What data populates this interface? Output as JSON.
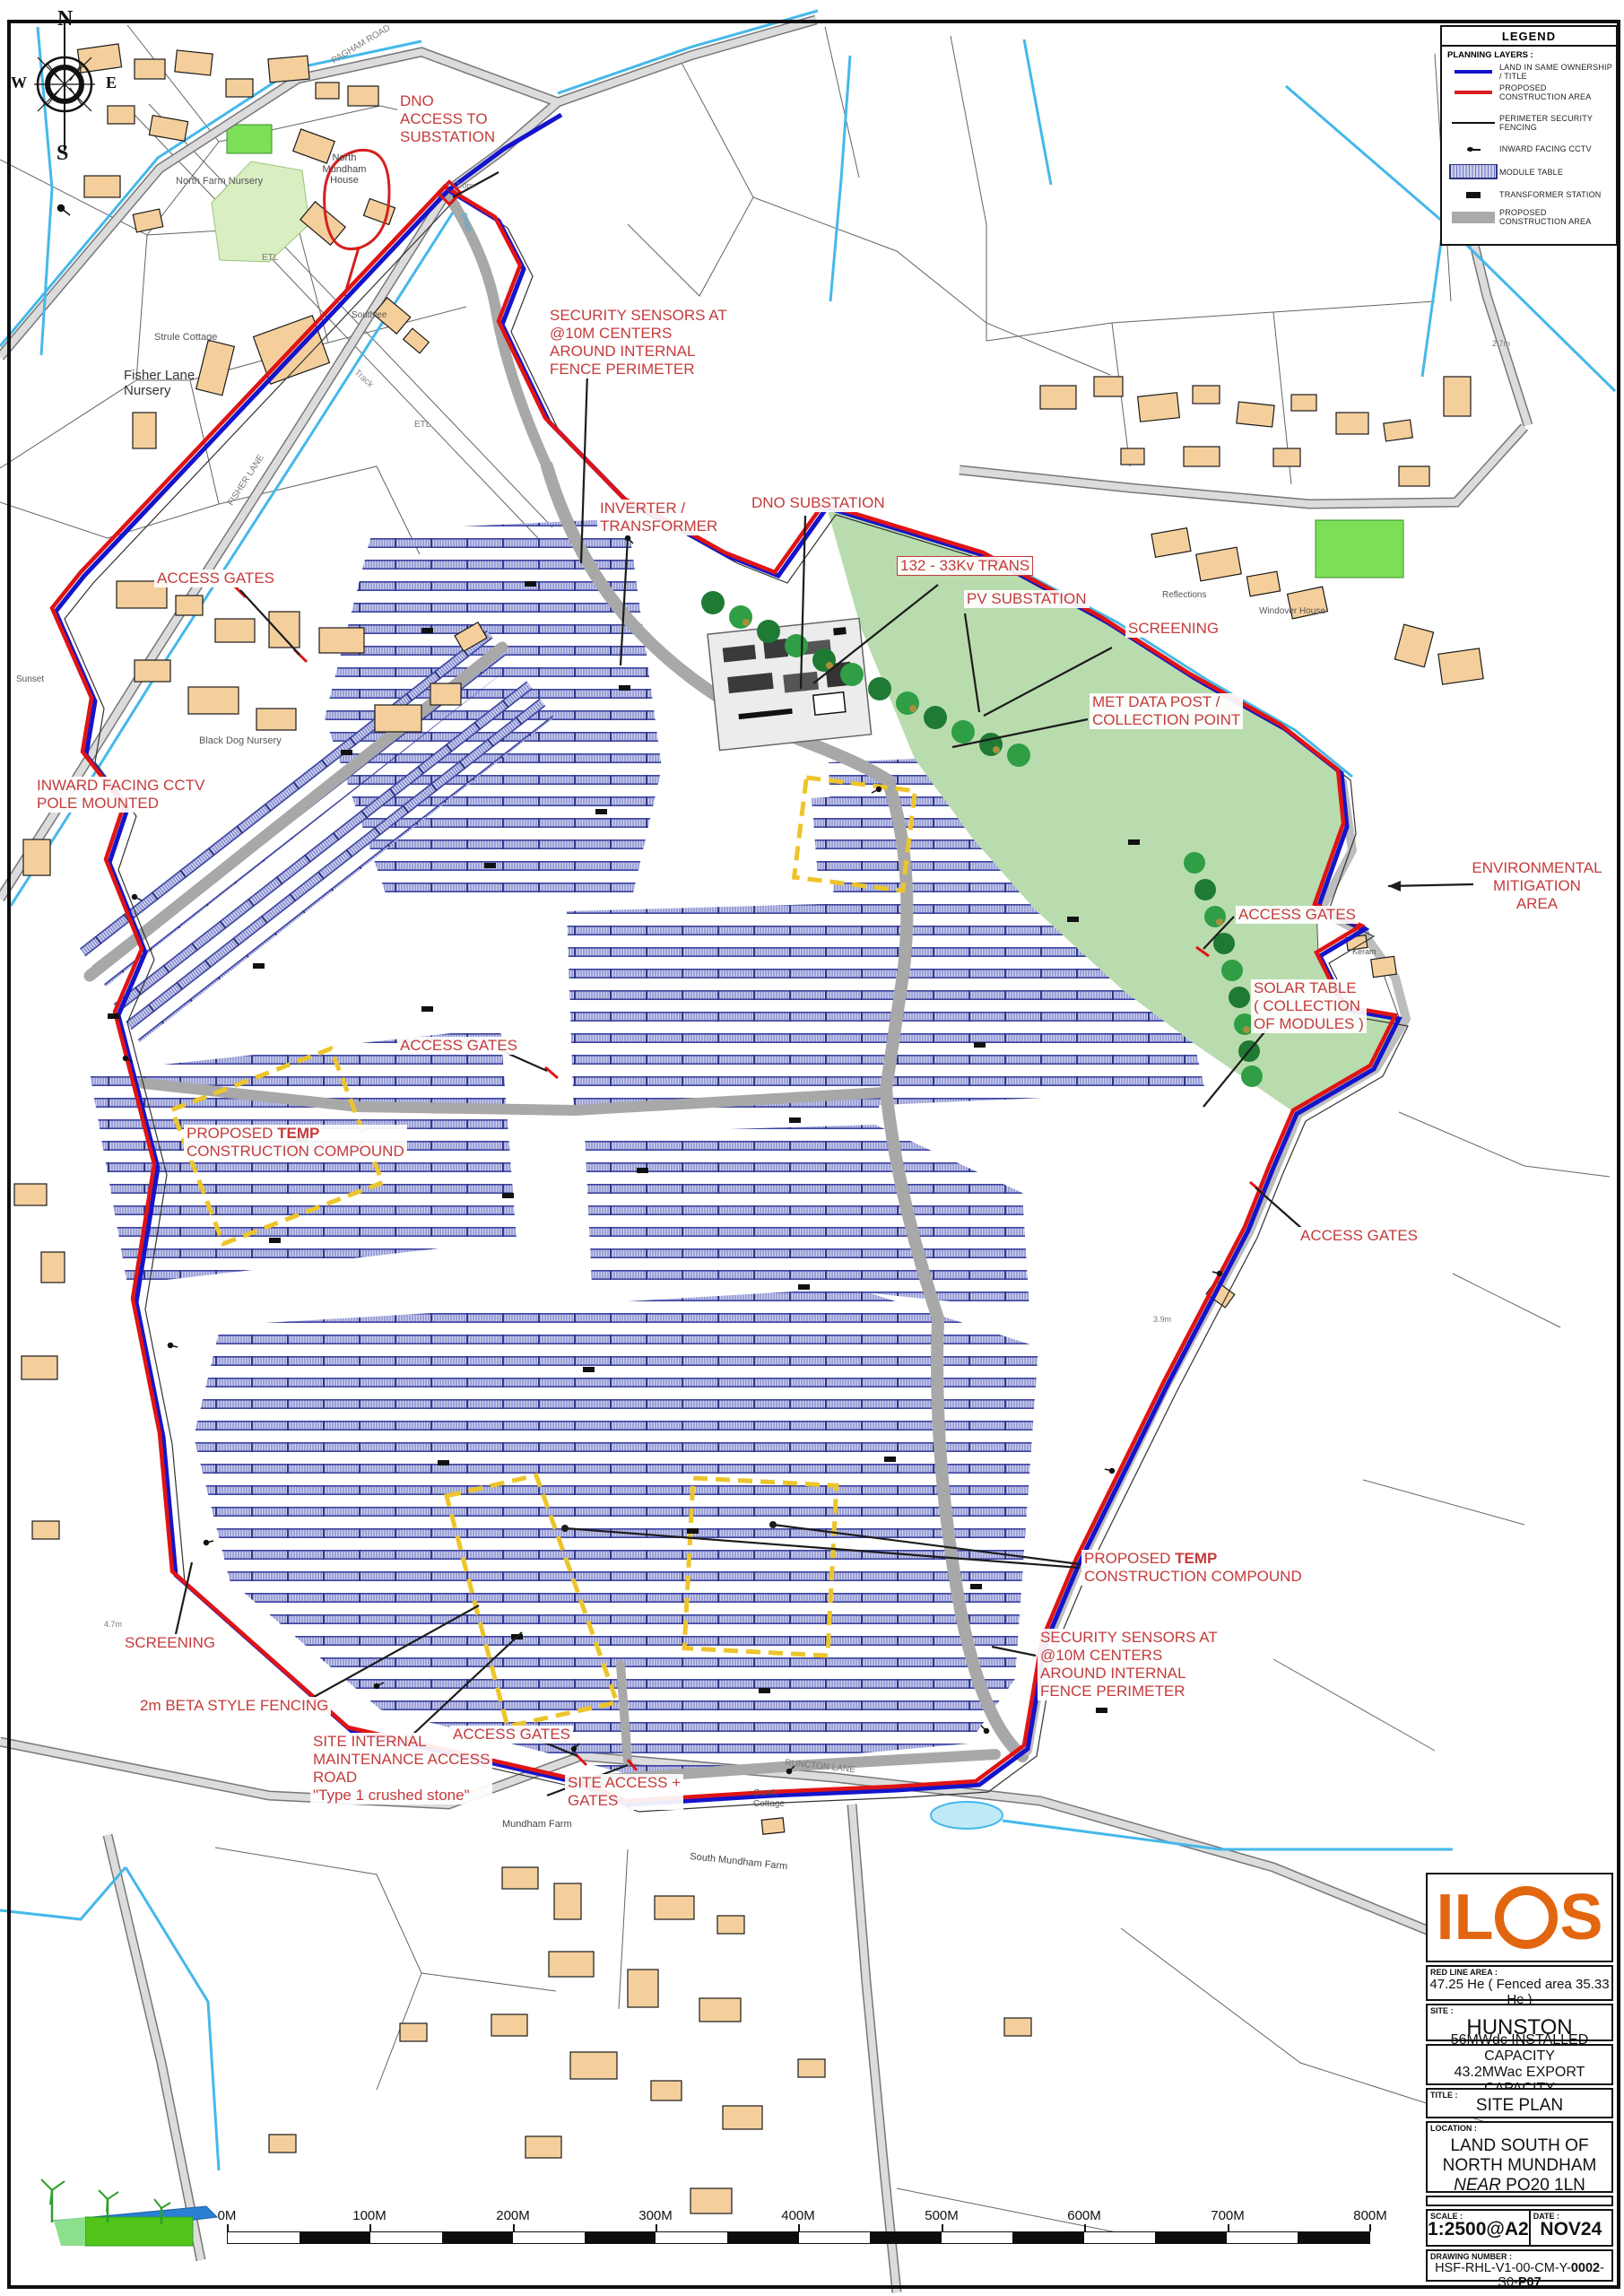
{
  "legend": {
    "title": "LEGEND",
    "section": "PLANNING LAYERS :",
    "items": [
      {
        "symbol": "blue-line",
        "label": "LAND IN SAME OWNERSHIP / TITLE"
      },
      {
        "symbol": "red-line",
        "label": "PROPOSED CONSTRUCTION AREA"
      },
      {
        "symbol": "black-line",
        "label": "PERIMETER SECURITY FENCING"
      },
      {
        "symbol": "cctv",
        "label": "INWARD FACING CCTV"
      },
      {
        "symbol": "module-table",
        "label": "MODULE TABLE"
      },
      {
        "symbol": "transformer",
        "label": "TRANSFORMER STATION"
      },
      {
        "symbol": "gray-area",
        "label": "PROPOSED CONSTRUCTION AREA"
      }
    ]
  },
  "title_block": {
    "logo": "ILOS",
    "red_line_area_label": "RED LINE AREA :",
    "red_line_area_value": "47.25 He ( Fenced area 35.33 He )",
    "site_label": "SITE :",
    "site_value": "HUNSTON",
    "capacity_line1": "56MWdc INSTALLED CAPACITY",
    "capacity_line2": "43.2MWac EXPORT CAPACITY",
    "title_label": "TITLE :",
    "title_value": "SITE PLAN",
    "location_label": "LOCATION :",
    "location_line1": "LAND SOUTH OF",
    "location_line2": "NORTH MUNDHAM",
    "location_line3_italic": "NEAR",
    "location_line3_rest": " PO20 1LN",
    "scale_label": "SCALE :",
    "scale_value": "1:2500@A2",
    "date_label": "DATE :",
    "date_value": "NOV24",
    "drawing_number_label": "DRAWING NUMBER :",
    "dwg_prefix": "HSF-RHL-V1-00-CM-Y-",
    "dwg_bold1": "0002",
    "dwg_mid": "-S0-",
    "dwg_bold2": "P07"
  },
  "compass": {
    "n": "N",
    "s": "S",
    "w": "W",
    "e": "E"
  },
  "scale_bar": {
    "labels": [
      "0M",
      "100M",
      "200M",
      "300M",
      "400M",
      "500M",
      "600M",
      "700M",
      "800M"
    ]
  },
  "annotations": [
    "DNO\nACCESS TO\nSUBSTATION",
    "SECURITY SENSORS AT\n@10M CENTERS\nAROUND INTERNAL\nFENCE PERIMETER",
    "INVERTER /\nTRANSFORMER",
    "DNO SUBSTATION",
    "132 - 33Kv TRANS",
    "PV SUBSTATION",
    "SCREENING",
    "MET DATA POST /\nCOLLECTION POINT",
    "ENVIRONMENTAL\nMITIGATION\nAREA",
    "ACCESS GATES",
    "SOLAR TABLE\n( COLLECTION\nOF MODULES )",
    "ACCESS GATES",
    "ACCESS GATES",
    "INWARD FACING CCTV\nPOLE MOUNTED",
    "ACCESS GATES",
    "SCREENING",
    "2m BETA STYLE FENCING",
    "SITE INTERNAL\nMAINTENANCE ACCESS\nROAD\n\"Type 1 crushed stone\"",
    "ACCESS GATES",
    "SITE ACCESS +\nGATES",
    "SECURITY SENSORS AT\n@10M CENTERS\nAROUND INTERNAL\nFENCE PERIMETER"
  ],
  "temp_annotation": {
    "pre": "PROPOSED ",
    "bold": "TEMP",
    "line2": "CONSTRUCTION COMPOUND"
  },
  "map_labels": [
    "North Farm Nursery",
    "North\nMundham\nHouse",
    "Strule Cottage",
    "Fisher Lane\nNursery",
    "Southlee",
    "Black Dog Nursery",
    "Sunset",
    "Reflections",
    "Windover House",
    "South Mundham Farm",
    "Camic\nCottage",
    "Mundham Farm",
    "PAGHAM ROAD",
    "FISHER LANE",
    "RUNCTON LANE",
    "Track",
    "ETL",
    "ETL",
    "Drain",
    "Keram",
    "7.0m",
    "4.7m",
    "3.9m",
    "2.7m"
  ]
}
